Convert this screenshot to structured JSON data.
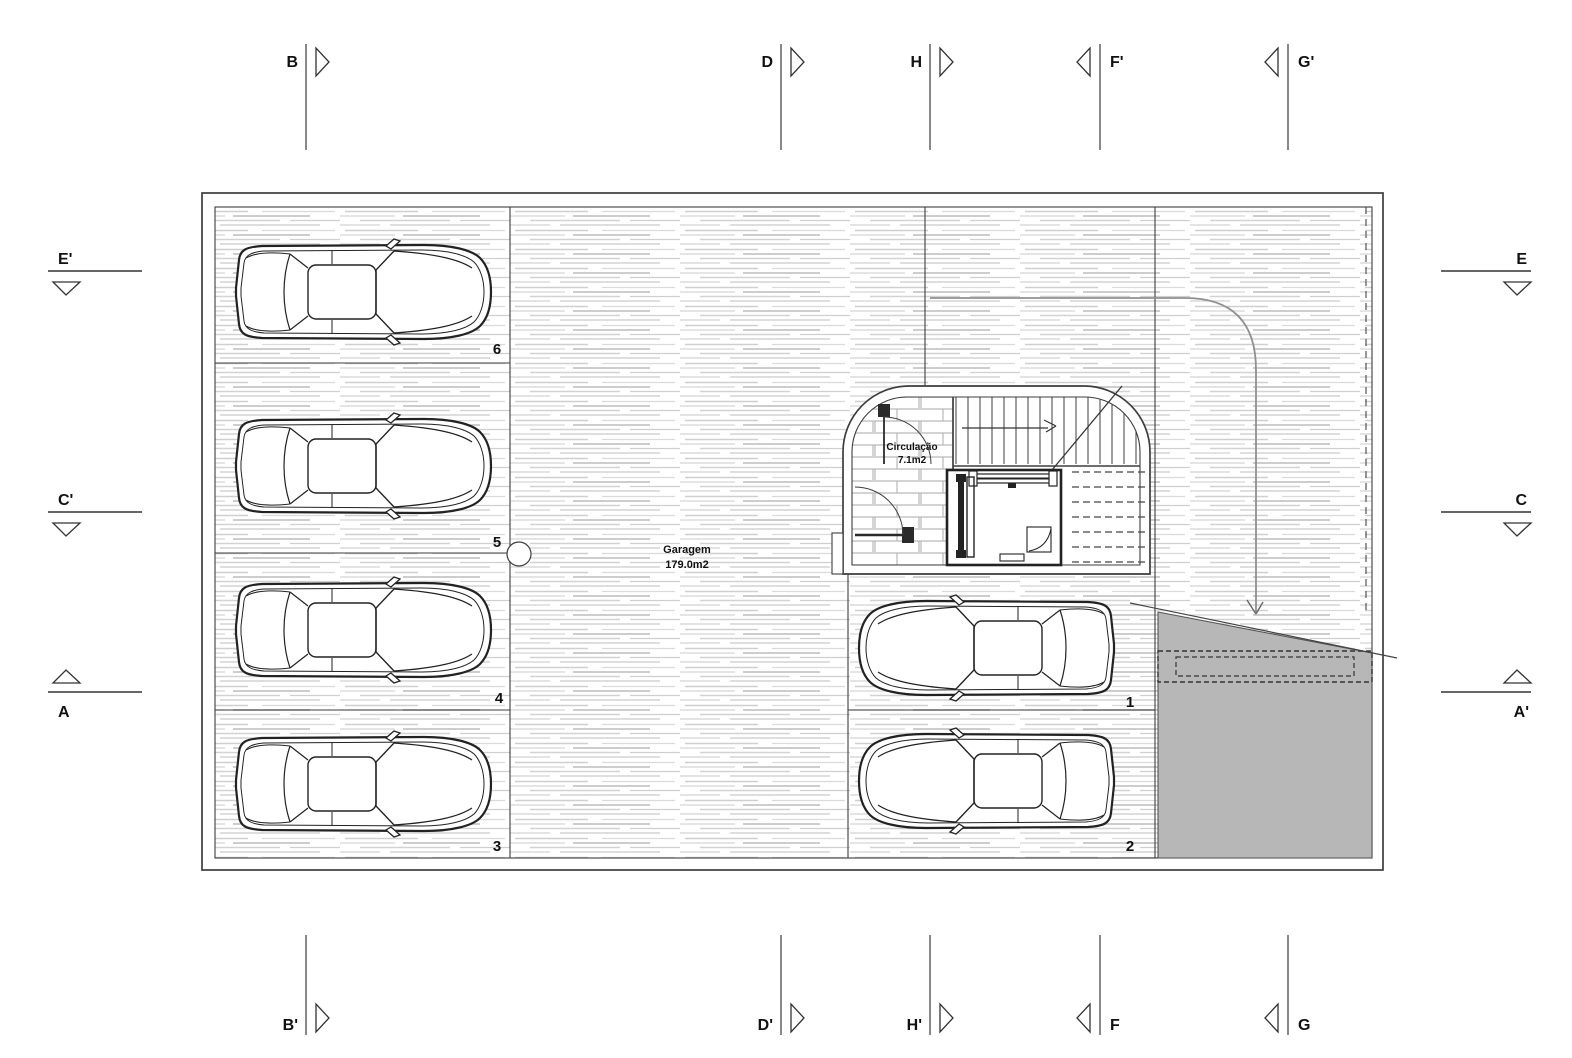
{
  "plan": {
    "rooms": {
      "garage": {
        "name": "Garagem",
        "area": "179.0m2"
      },
      "circulation": {
        "name": "Circulação",
        "area": "7.1m2"
      }
    },
    "parking_spots": {
      "s1": "1",
      "s2": "2",
      "s3": "3",
      "s4": "4",
      "s5": "5",
      "s6": "6"
    }
  },
  "section_markers": {
    "top": [
      {
        "label": "B"
      },
      {
        "label": "D"
      },
      {
        "label": "H"
      },
      {
        "label": "F'"
      },
      {
        "label": "G'"
      }
    ],
    "bottom": [
      {
        "label": "B'"
      },
      {
        "label": "D'"
      },
      {
        "label": "H'"
      },
      {
        "label": "F"
      },
      {
        "label": "G"
      }
    ],
    "left": [
      {
        "label": "E'"
      },
      {
        "label": "C'"
      },
      {
        "label": "A"
      }
    ],
    "right": [
      {
        "label": "E"
      },
      {
        "label": "C"
      },
      {
        "label": "A'"
      }
    ]
  },
  "colors": {
    "ink": "#3d3d3d",
    "hatch_line": "#cccccc",
    "ramp_fill": "#b7b7b7",
    "drive_path": "#909090"
  }
}
